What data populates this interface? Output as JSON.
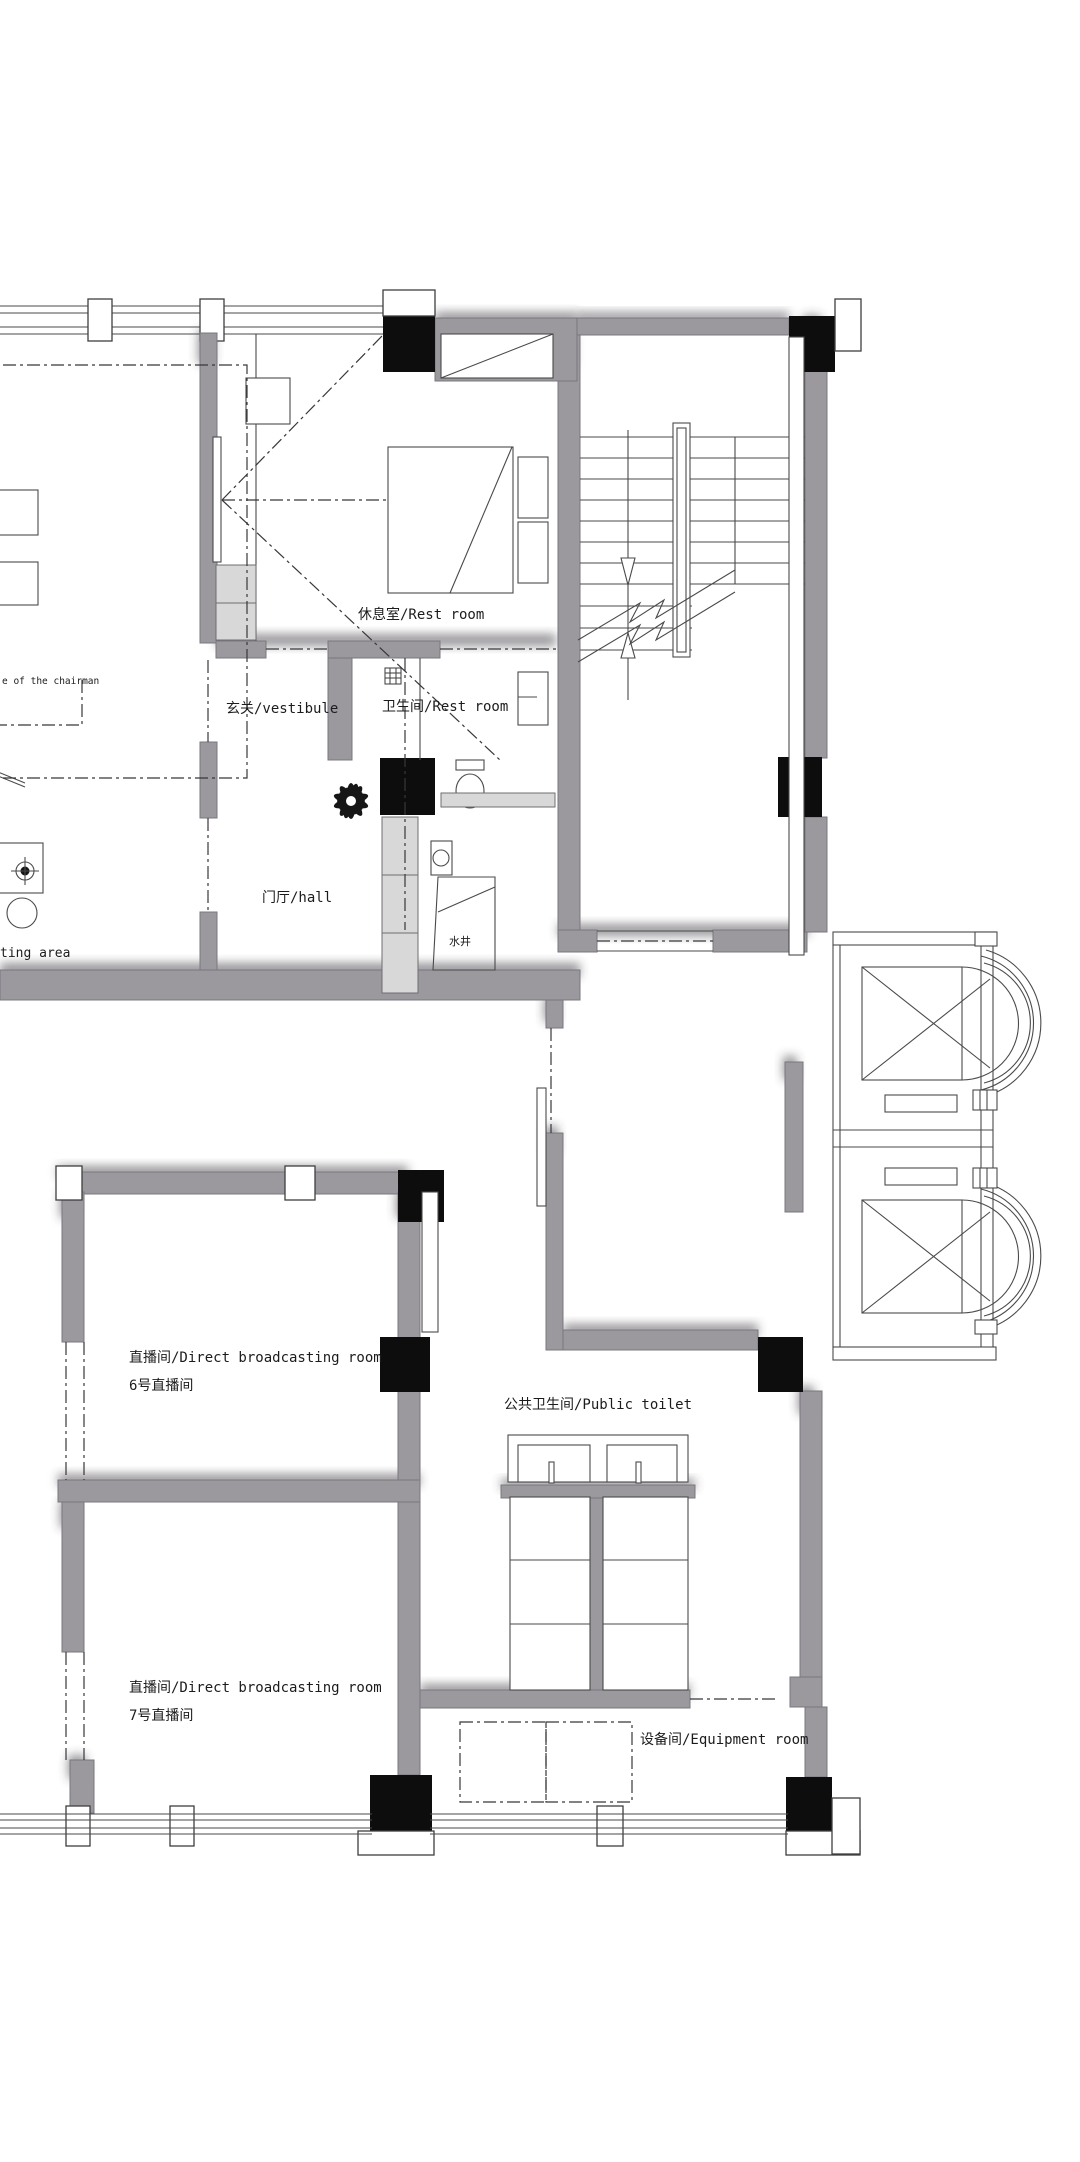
{
  "labels": {
    "chairman_office": "e of the chairman",
    "vestibule": "玄关/vestibule",
    "rest_room": "休息室/Rest room",
    "bathroom": "卫生间/Rest room",
    "hall": "门厅/hall",
    "water_well": "水井",
    "sitting_area": "ting area",
    "broadcast_room_6_title": "直播间/Direct broadcasting room",
    "broadcast_room_6_sub": "6号直播间",
    "broadcast_room_7_title": "直播间/Direct broadcasting room",
    "broadcast_room_7_sub": "7号直播间",
    "public_toilet": "公共卫生间/Public toilet",
    "equipment_room": "设备间/Equipment room"
  },
  "colors": {
    "wall": "#9b999e",
    "column": "#0d0d0d",
    "line": "#4a4a4a",
    "cabinet": "#d8d8d8",
    "text": "#1c1c1c",
    "paper": "#ffffff"
  }
}
